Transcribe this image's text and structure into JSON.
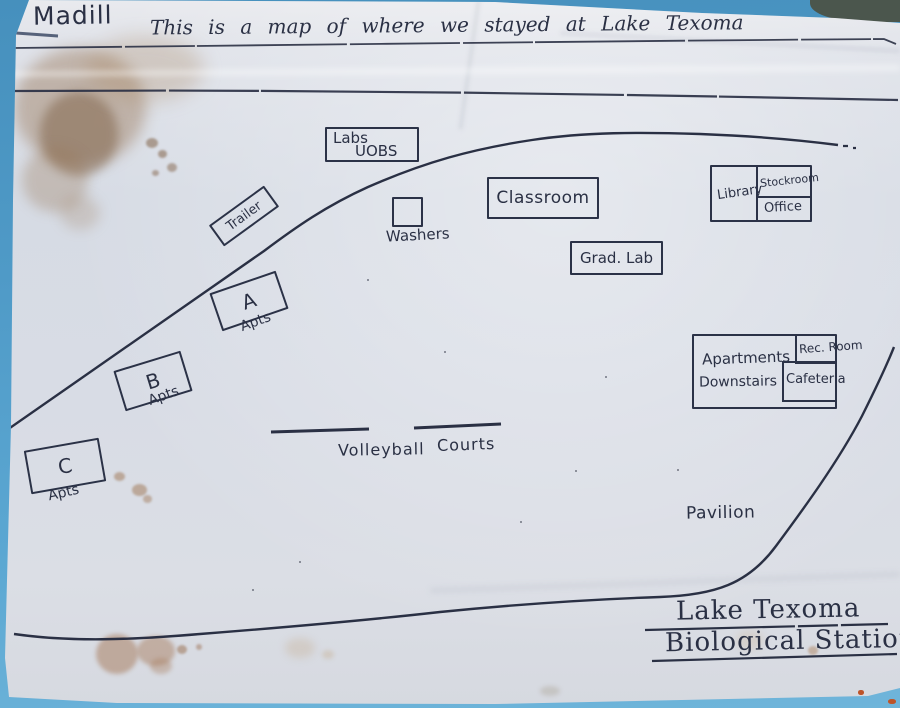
{
  "colors": {
    "background_blue": "#4f9ac7",
    "paper": "#d9dde5",
    "ink": "#2a3044",
    "stain_brown": "#8a6647"
  },
  "header": {
    "town": "Madill",
    "title": "This is a map of where we stayed at Lake Texoma"
  },
  "labels": {
    "labs_line1": "Labs",
    "labs_line2": "UOBS",
    "trailer": "Trailer",
    "washers": "Washers",
    "classroom": "Classroom",
    "library": "Library",
    "stockroom": "Stockroom",
    "office": "Office",
    "grad_lab": "Grad. Lab",
    "apt_a": "A",
    "apt_b": "B",
    "apt_c": "C",
    "apts": "Apts",
    "apartments_line1": "Apartments",
    "apartments_line2": "Downstairs",
    "rec_room": "Rec. Room",
    "cafeteria": "Cafeteria",
    "volleyball": "Volleyball",
    "courts": "Courts",
    "pavilion": "Pavilion"
  },
  "footer": {
    "line1": "Lake Texoma",
    "line2": "Biological Station"
  }
}
